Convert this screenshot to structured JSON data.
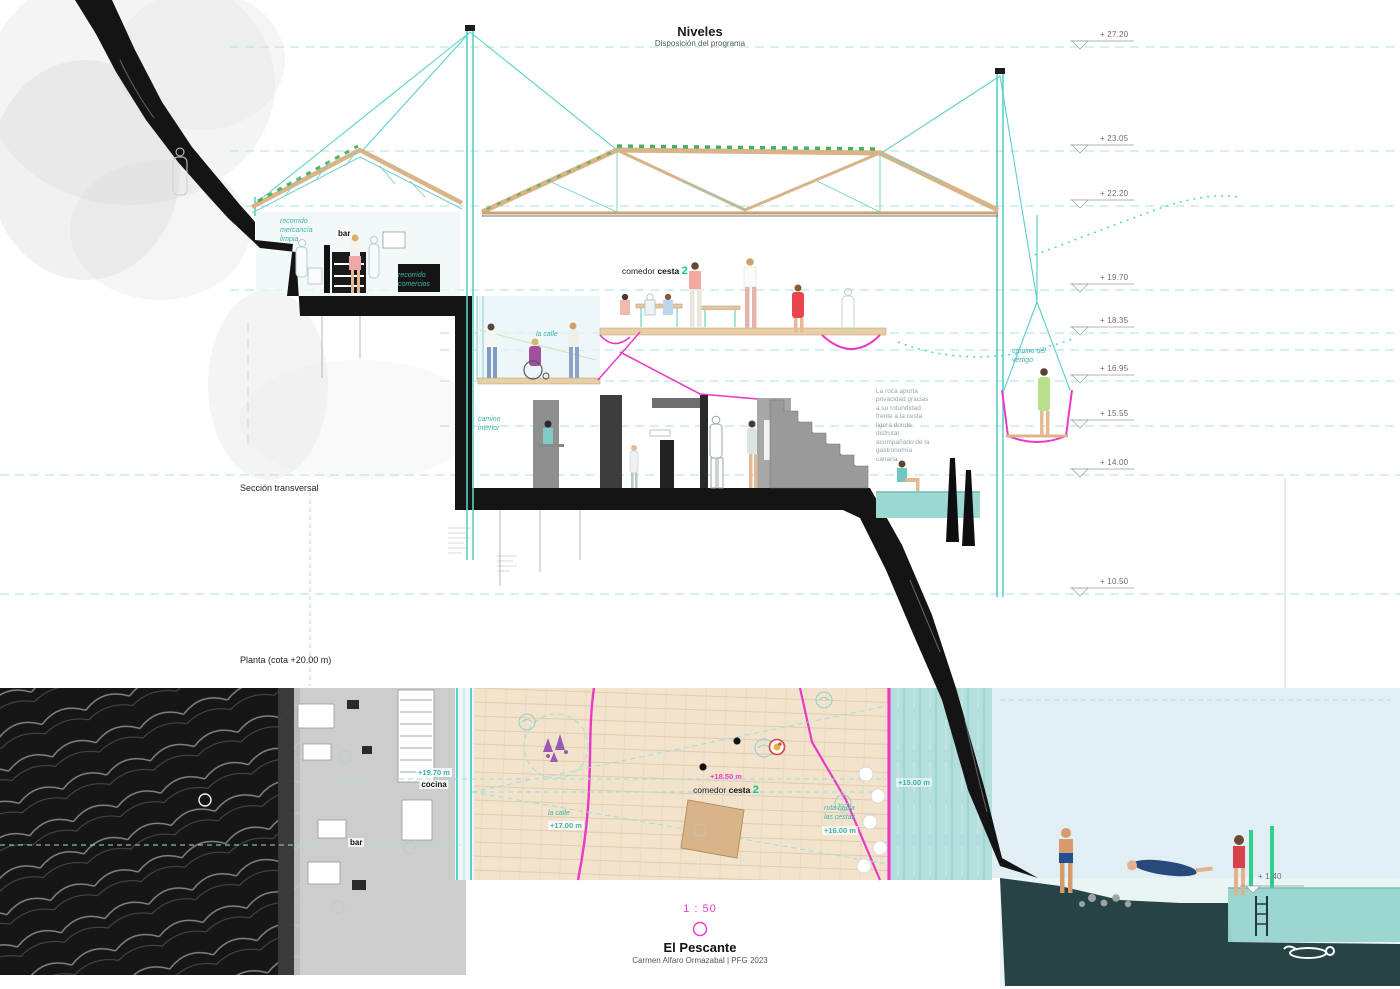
{
  "title_block": {
    "title": "Niveles",
    "subtitle": "Disposición del programa"
  },
  "section": {
    "label": "Sección transversal",
    "levels": [
      {
        "value": "+ 27.20"
      },
      {
        "value": "+ 23.05"
      },
      {
        "value": "+ 22.20"
      },
      {
        "value": "+ 19.70"
      },
      {
        "value": "+ 18.35"
      },
      {
        "value": "+ 16.95"
      },
      {
        "value": "+ 15.55"
      },
      {
        "value": "+ 14.00"
      },
      {
        "value": "+ 10.50"
      }
    ],
    "labels": {
      "bar": "bar",
      "recorrido_mercancia": "recorrido mercancía limpia",
      "recorrido_comercios": "recorrido comercios",
      "comedor": "comedor",
      "cesta": "cesta",
      "cesta_num": "2",
      "la_calle": "la calle",
      "camino_interior": "camino interior",
      "camino_vertigo": "camino del vértigo",
      "nota_roca": "La roca aporta privacidad gracias a su rotundidad frente a la cesta ligera donde disfrutar acompañado de la gastronomía canaria"
    }
  },
  "plan": {
    "label": "Planta (cota +20.00 m)",
    "labels": {
      "cocina": "cocina",
      "cocina_level": "+19.70 m",
      "bar": "bar",
      "la_calle": "la calle",
      "calle_level": "+17.00 m",
      "comedor": "comedor",
      "cesta": "cesta",
      "cesta_num": "2",
      "comedor_level": "+18.50 m",
      "ruta_cestas": "ruta hacia las cestas",
      "ruta_level": "+16.00 m",
      "agua_level": "+15.00 m",
      "mar_level": "+ 1.40"
    }
  },
  "footer": {
    "scale": "1 : 50",
    "title": "El Pescante",
    "credits": "Carmen Alfaro Ormazabal | PFG 2023"
  },
  "colors": {
    "teal": "#4db8b0",
    "cyan_dash": "#a9e2de",
    "magenta": "#e93ac6",
    "green_num": "#12c48b",
    "roof_wood": "#d9b488",
    "rock_black": "#141414",
    "water": "#aadbd8",
    "sky": "#e1eff4",
    "hatch_green": "#35a854"
  }
}
